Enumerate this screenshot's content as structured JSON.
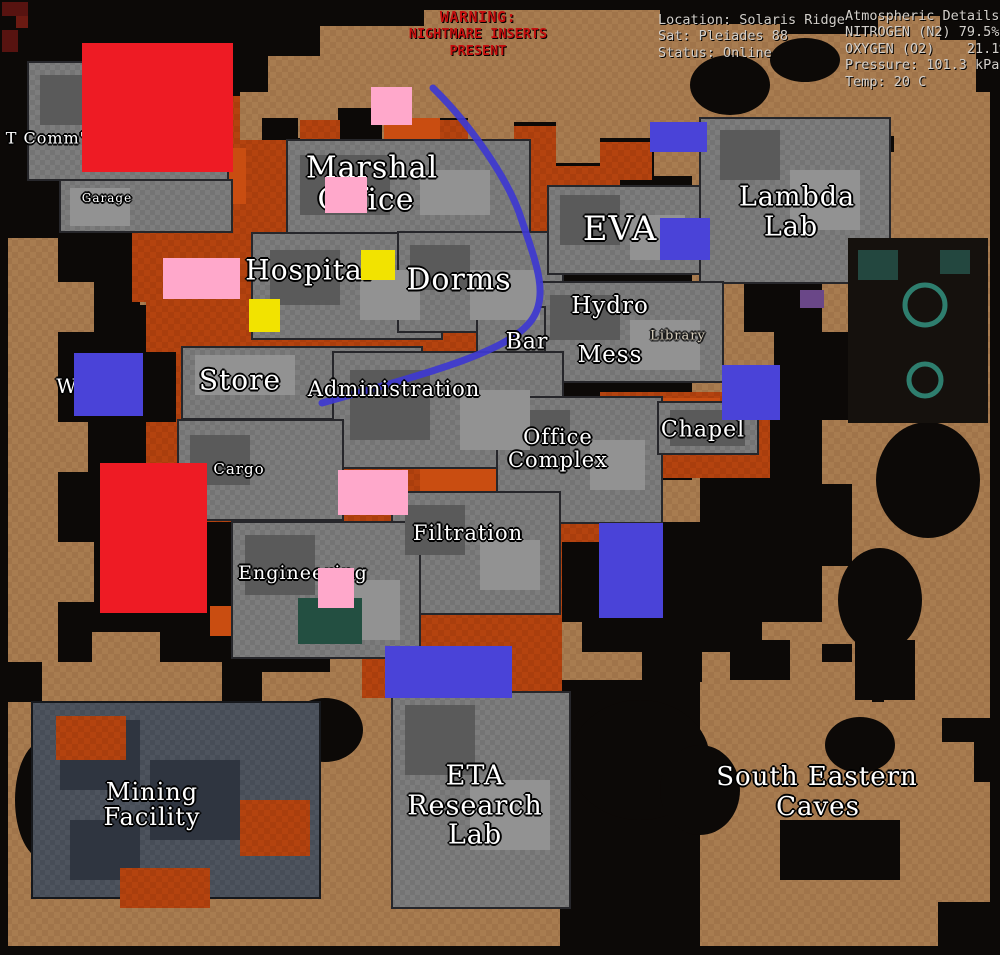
{
  "header": {
    "warning": {
      "color": "#c60f0f",
      "lines": [
        "WARNING:",
        "NIGHTMARE INSERTS",
        "PRESENT"
      ]
    },
    "location": {
      "lines": [
        "Location: Solaris Ridge",
        "Sat: Pleiades 88",
        "Status: Online"
      ]
    },
    "atmosphere": {
      "lines": [
        "Atmospheric Details:",
        "NITROGEN (N2) 79.5%",
        "OXYGEN (O2)    21.1%",
        "Pressure: 101.3 kPa",
        "Temp: 20 C"
      ]
    }
  },
  "map": {
    "labels": [
      {
        "id": "t-comms",
        "text": "T Comm's",
        "x": 50,
        "y": 138,
        "size": 16
      },
      {
        "id": "garage",
        "text": "Garage",
        "x": 107,
        "y": 198,
        "size": 12
      },
      {
        "id": "marshal-office-1",
        "text": "Marshal",
        "x": 372,
        "y": 168,
        "size": 30
      },
      {
        "id": "marshal-office-2",
        "text": "Office",
        "x": 366,
        "y": 200,
        "size": 30
      },
      {
        "id": "hospital",
        "text": "Hospital",
        "x": 309,
        "y": 270,
        "size": 28
      },
      {
        "id": "dorms",
        "text": "Dorms",
        "x": 459,
        "y": 280,
        "size": 30
      },
      {
        "id": "eva",
        "text": "EVA",
        "x": 620,
        "y": 229,
        "size": 34
      },
      {
        "id": "lambda-lab-1",
        "text": "Lambda",
        "x": 797,
        "y": 197,
        "size": 27
      },
      {
        "id": "lambda-lab-2",
        "text": "Lab",
        "x": 791,
        "y": 227,
        "size": 27
      },
      {
        "id": "hydro",
        "text": "Hydro",
        "x": 610,
        "y": 306,
        "size": 23
      },
      {
        "id": "bar",
        "text": "Bar",
        "x": 527,
        "y": 342,
        "size": 22
      },
      {
        "id": "mess",
        "text": "Mess",
        "x": 610,
        "y": 355,
        "size": 23
      },
      {
        "id": "library",
        "text": "Library",
        "x": 678,
        "y": 336,
        "size": 13,
        "dim": true
      },
      {
        "id": "store",
        "text": "Store",
        "x": 240,
        "y": 380,
        "size": 28
      },
      {
        "id": "administration",
        "text": "Administration",
        "x": 394,
        "y": 389,
        "size": 21
      },
      {
        "id": "chapel",
        "text": "Chapel",
        "x": 703,
        "y": 430,
        "size": 22
      },
      {
        "id": "office-complex-1",
        "text": "Office",
        "x": 558,
        "y": 437,
        "size": 21
      },
      {
        "id": "office-complex-2",
        "text": "Complex",
        "x": 558,
        "y": 460,
        "size": 21
      },
      {
        "id": "cargo",
        "text": "Cargo",
        "x": 239,
        "y": 469,
        "size": 15
      },
      {
        "id": "west-partial",
        "text": "W",
        "x": 67,
        "y": 386,
        "size": 20
      },
      {
        "id": "filtration",
        "text": "Filtration",
        "x": 468,
        "y": 533,
        "size": 21
      },
      {
        "id": "engineering",
        "text": "Engineering",
        "x": 303,
        "y": 573,
        "size": 19
      },
      {
        "id": "mining-facility-1",
        "text": "Mining",
        "x": 152,
        "y": 792,
        "size": 24
      },
      {
        "id": "mining-facility-2",
        "text": "Facility",
        "x": 152,
        "y": 817,
        "size": 24
      },
      {
        "id": "eta-lab-1",
        "text": "ETA",
        "x": 475,
        "y": 776,
        "size": 27
      },
      {
        "id": "eta-lab-2",
        "text": "Research",
        "x": 475,
        "y": 806,
        "size": 27
      },
      {
        "id": "eta-lab-3",
        "text": "Lab",
        "x": 475,
        "y": 835,
        "size": 27
      },
      {
        "id": "south-eastern-caves-1",
        "text": "South Eastern",
        "x": 817,
        "y": 777,
        "size": 26
      },
      {
        "id": "south-eastern-caves-2",
        "text": "Caves",
        "x": 818,
        "y": 807,
        "size": 26
      }
    ]
  },
  "annotations": {
    "colors": {
      "red": "#ee1b24",
      "pink": "#ffa8cb",
      "yellow": "#f2e300",
      "blue": "#4a43d8",
      "route": "#3e38d0"
    },
    "rects": [
      {
        "color": "red",
        "x": 82,
        "y": 43,
        "w": 151,
        "h": 129
      },
      {
        "color": "red",
        "x": 100,
        "y": 463,
        "w": 107,
        "h": 150
      },
      {
        "color": "pink",
        "x": 371,
        "y": 87,
        "w": 41,
        "h": 38
      },
      {
        "color": "pink",
        "x": 325,
        "y": 177,
        "w": 42,
        "h": 36
      },
      {
        "color": "pink",
        "x": 163,
        "y": 258,
        "w": 77,
        "h": 41
      },
      {
        "color": "pink",
        "x": 338,
        "y": 470,
        "w": 70,
        "h": 45
      },
      {
        "color": "pink",
        "x": 318,
        "y": 568,
        "w": 36,
        "h": 40
      },
      {
        "color": "yellow",
        "x": 361,
        "y": 250,
        "w": 34,
        "h": 30
      },
      {
        "color": "yellow",
        "x": 249,
        "y": 299,
        "w": 31,
        "h": 33
      },
      {
        "color": "blue",
        "x": 650,
        "y": 122,
        "w": 57,
        "h": 30
      },
      {
        "color": "blue",
        "x": 660,
        "y": 218,
        "w": 50,
        "h": 42
      },
      {
        "color": "blue",
        "x": 74,
        "y": 353,
        "w": 69,
        "h": 63
      },
      {
        "color": "blue",
        "x": 722,
        "y": 365,
        "w": 58,
        "h": 55
      },
      {
        "color": "blue",
        "x": 599,
        "y": 523,
        "w": 64,
        "h": 95
      },
      {
        "color": "blue",
        "x": 385,
        "y": 646,
        "w": 127,
        "h": 52
      }
    ],
    "route": {
      "path": "M433,88 C468,122 508,178 521,218 C535,260 549,293 533,318 C512,351 432,372 322,403"
    }
  }
}
